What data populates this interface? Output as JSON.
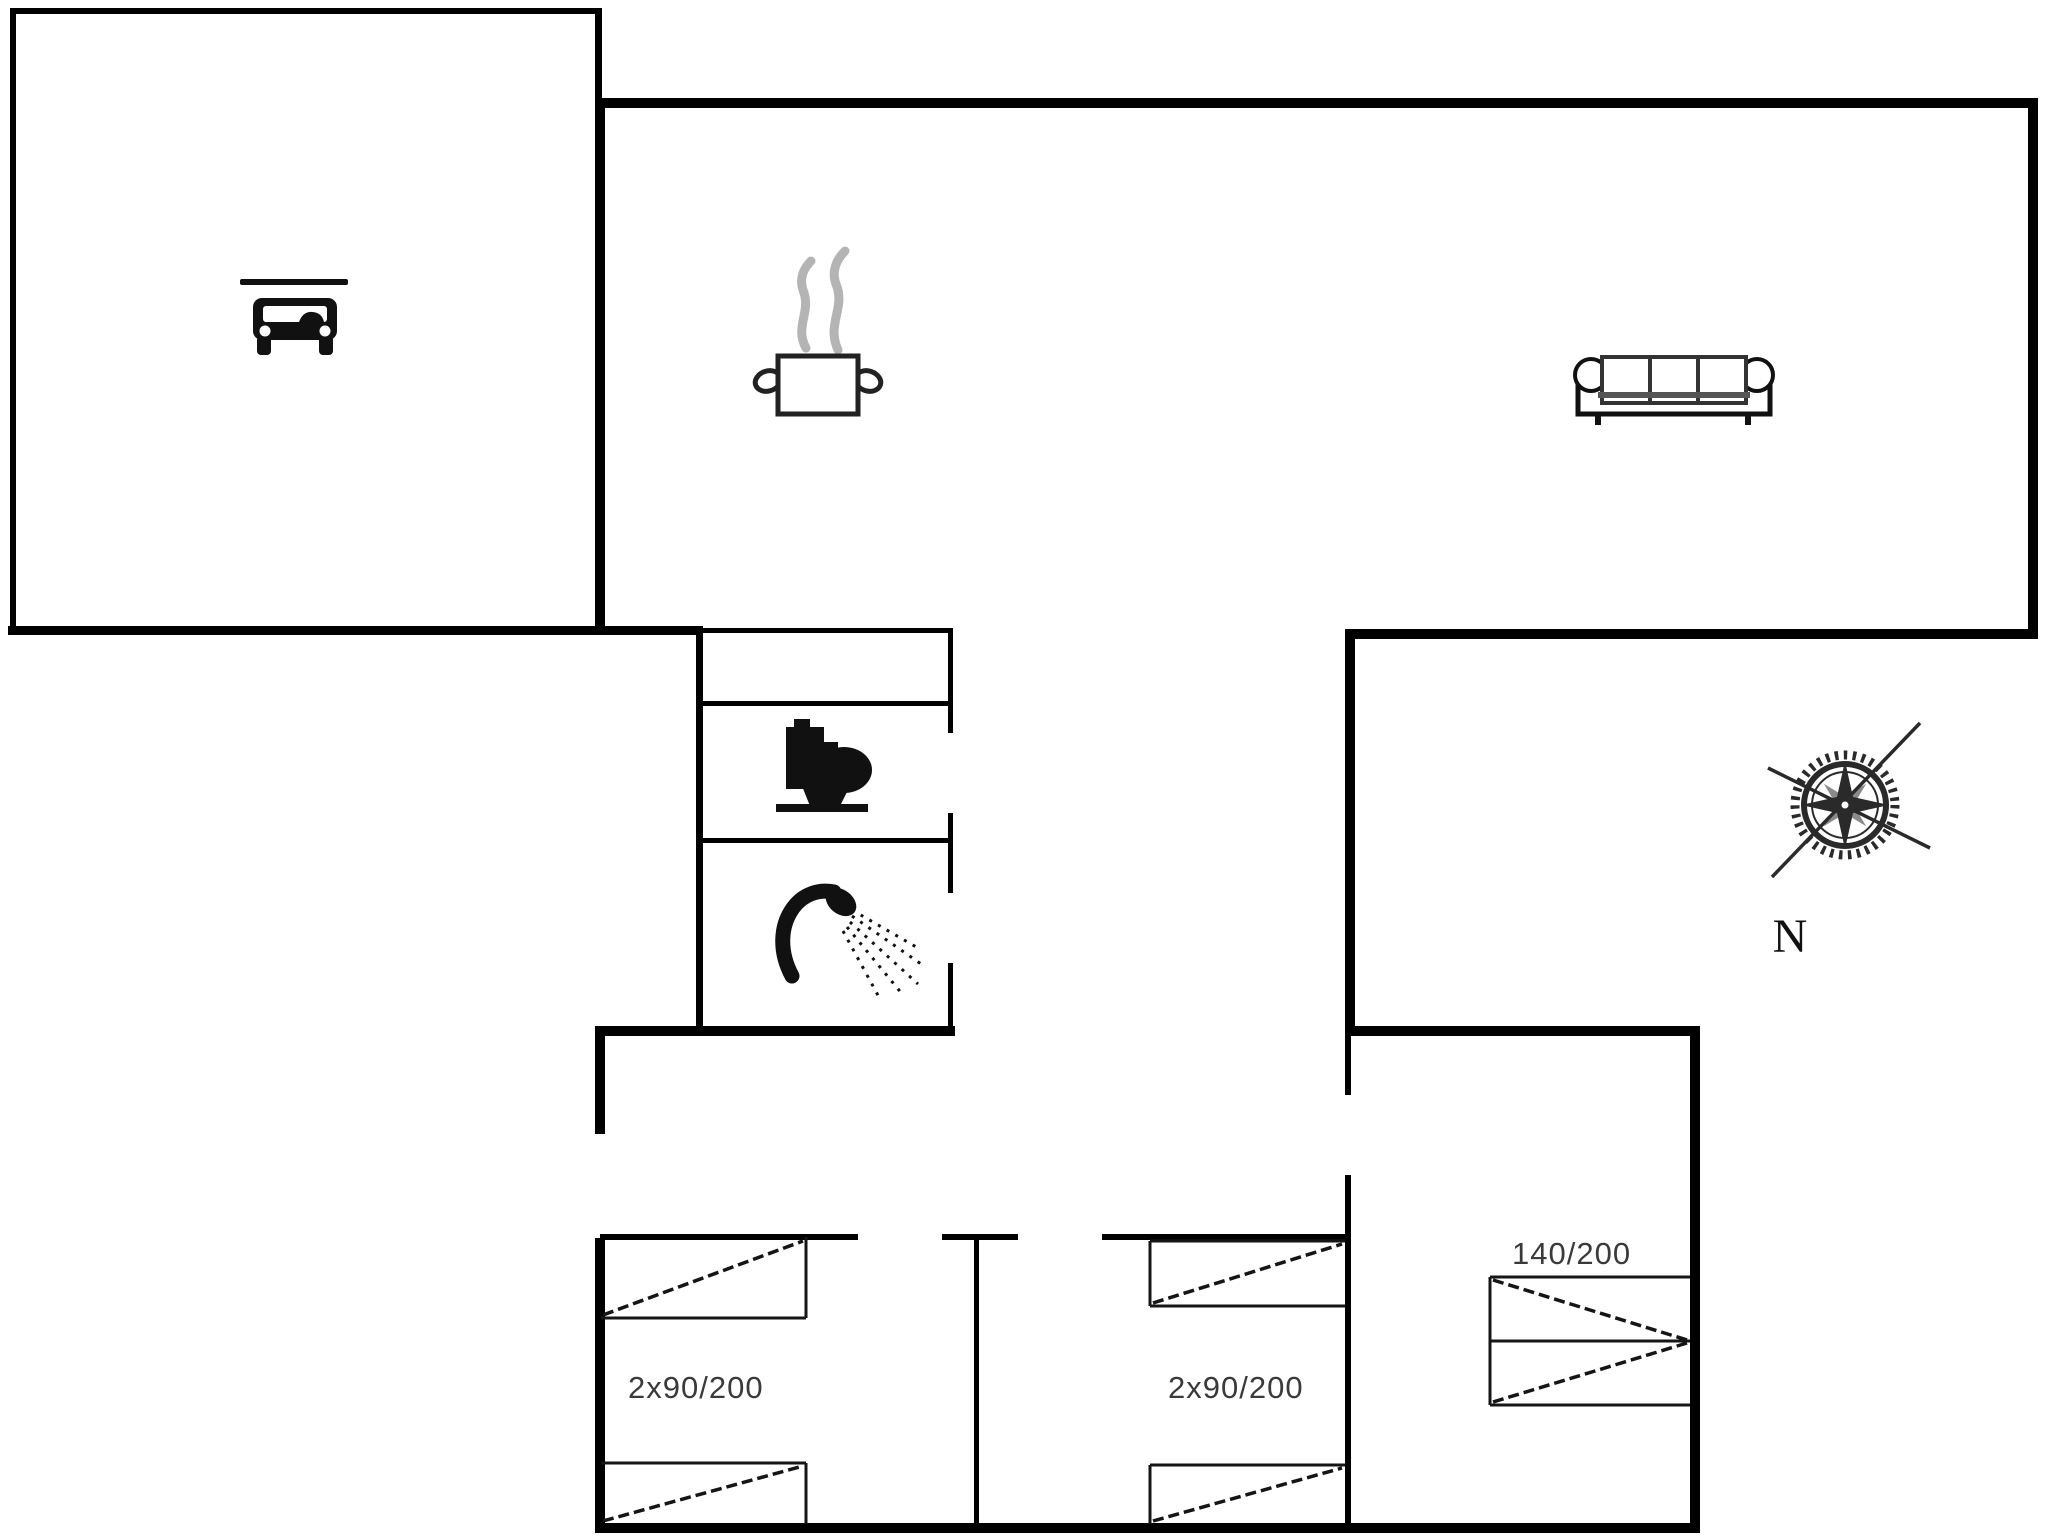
{
  "document": {
    "type": "floor-plan",
    "description": "Single-storey holiday house floor plan with garage, kitchen, living room, bathroom (toilet + shower), three bedrooms and compass rose"
  },
  "colors": {
    "background": "#ffffff",
    "wall": "#000000",
    "interior_wall": "#1a1a1a",
    "bed_line": "#151515",
    "label_text": "#3a3a3a",
    "steam_gray": "#b4b4b4",
    "compass_ink": "#2a2a2a"
  },
  "labels": {
    "bedroom_left_bed": "2x90/200",
    "bedroom_middle_bed": "2x90/200",
    "bedroom_right_bed": "140/200",
    "compass_north": "N"
  },
  "icons": [
    {
      "name": "car-icon",
      "room": "garage"
    },
    {
      "name": "garage-door-line",
      "room": "garage"
    },
    {
      "name": "cooking-pot-icon",
      "room": "kitchen"
    },
    {
      "name": "sofa-icon",
      "room": "living-room"
    },
    {
      "name": "toilet-icon",
      "room": "toilet-room"
    },
    {
      "name": "shower-icon",
      "room": "shower-room"
    },
    {
      "name": "compass-rose-icon",
      "room": "outside"
    }
  ],
  "rooms": [
    {
      "name": "garage"
    },
    {
      "name": "kitchen"
    },
    {
      "name": "living-room"
    },
    {
      "name": "entry-hall"
    },
    {
      "name": "closet-strip"
    },
    {
      "name": "toilet-room"
    },
    {
      "name": "shower-room"
    },
    {
      "name": "bedroom-left"
    },
    {
      "name": "bedroom-middle"
    },
    {
      "name": "bedroom-right"
    }
  ]
}
